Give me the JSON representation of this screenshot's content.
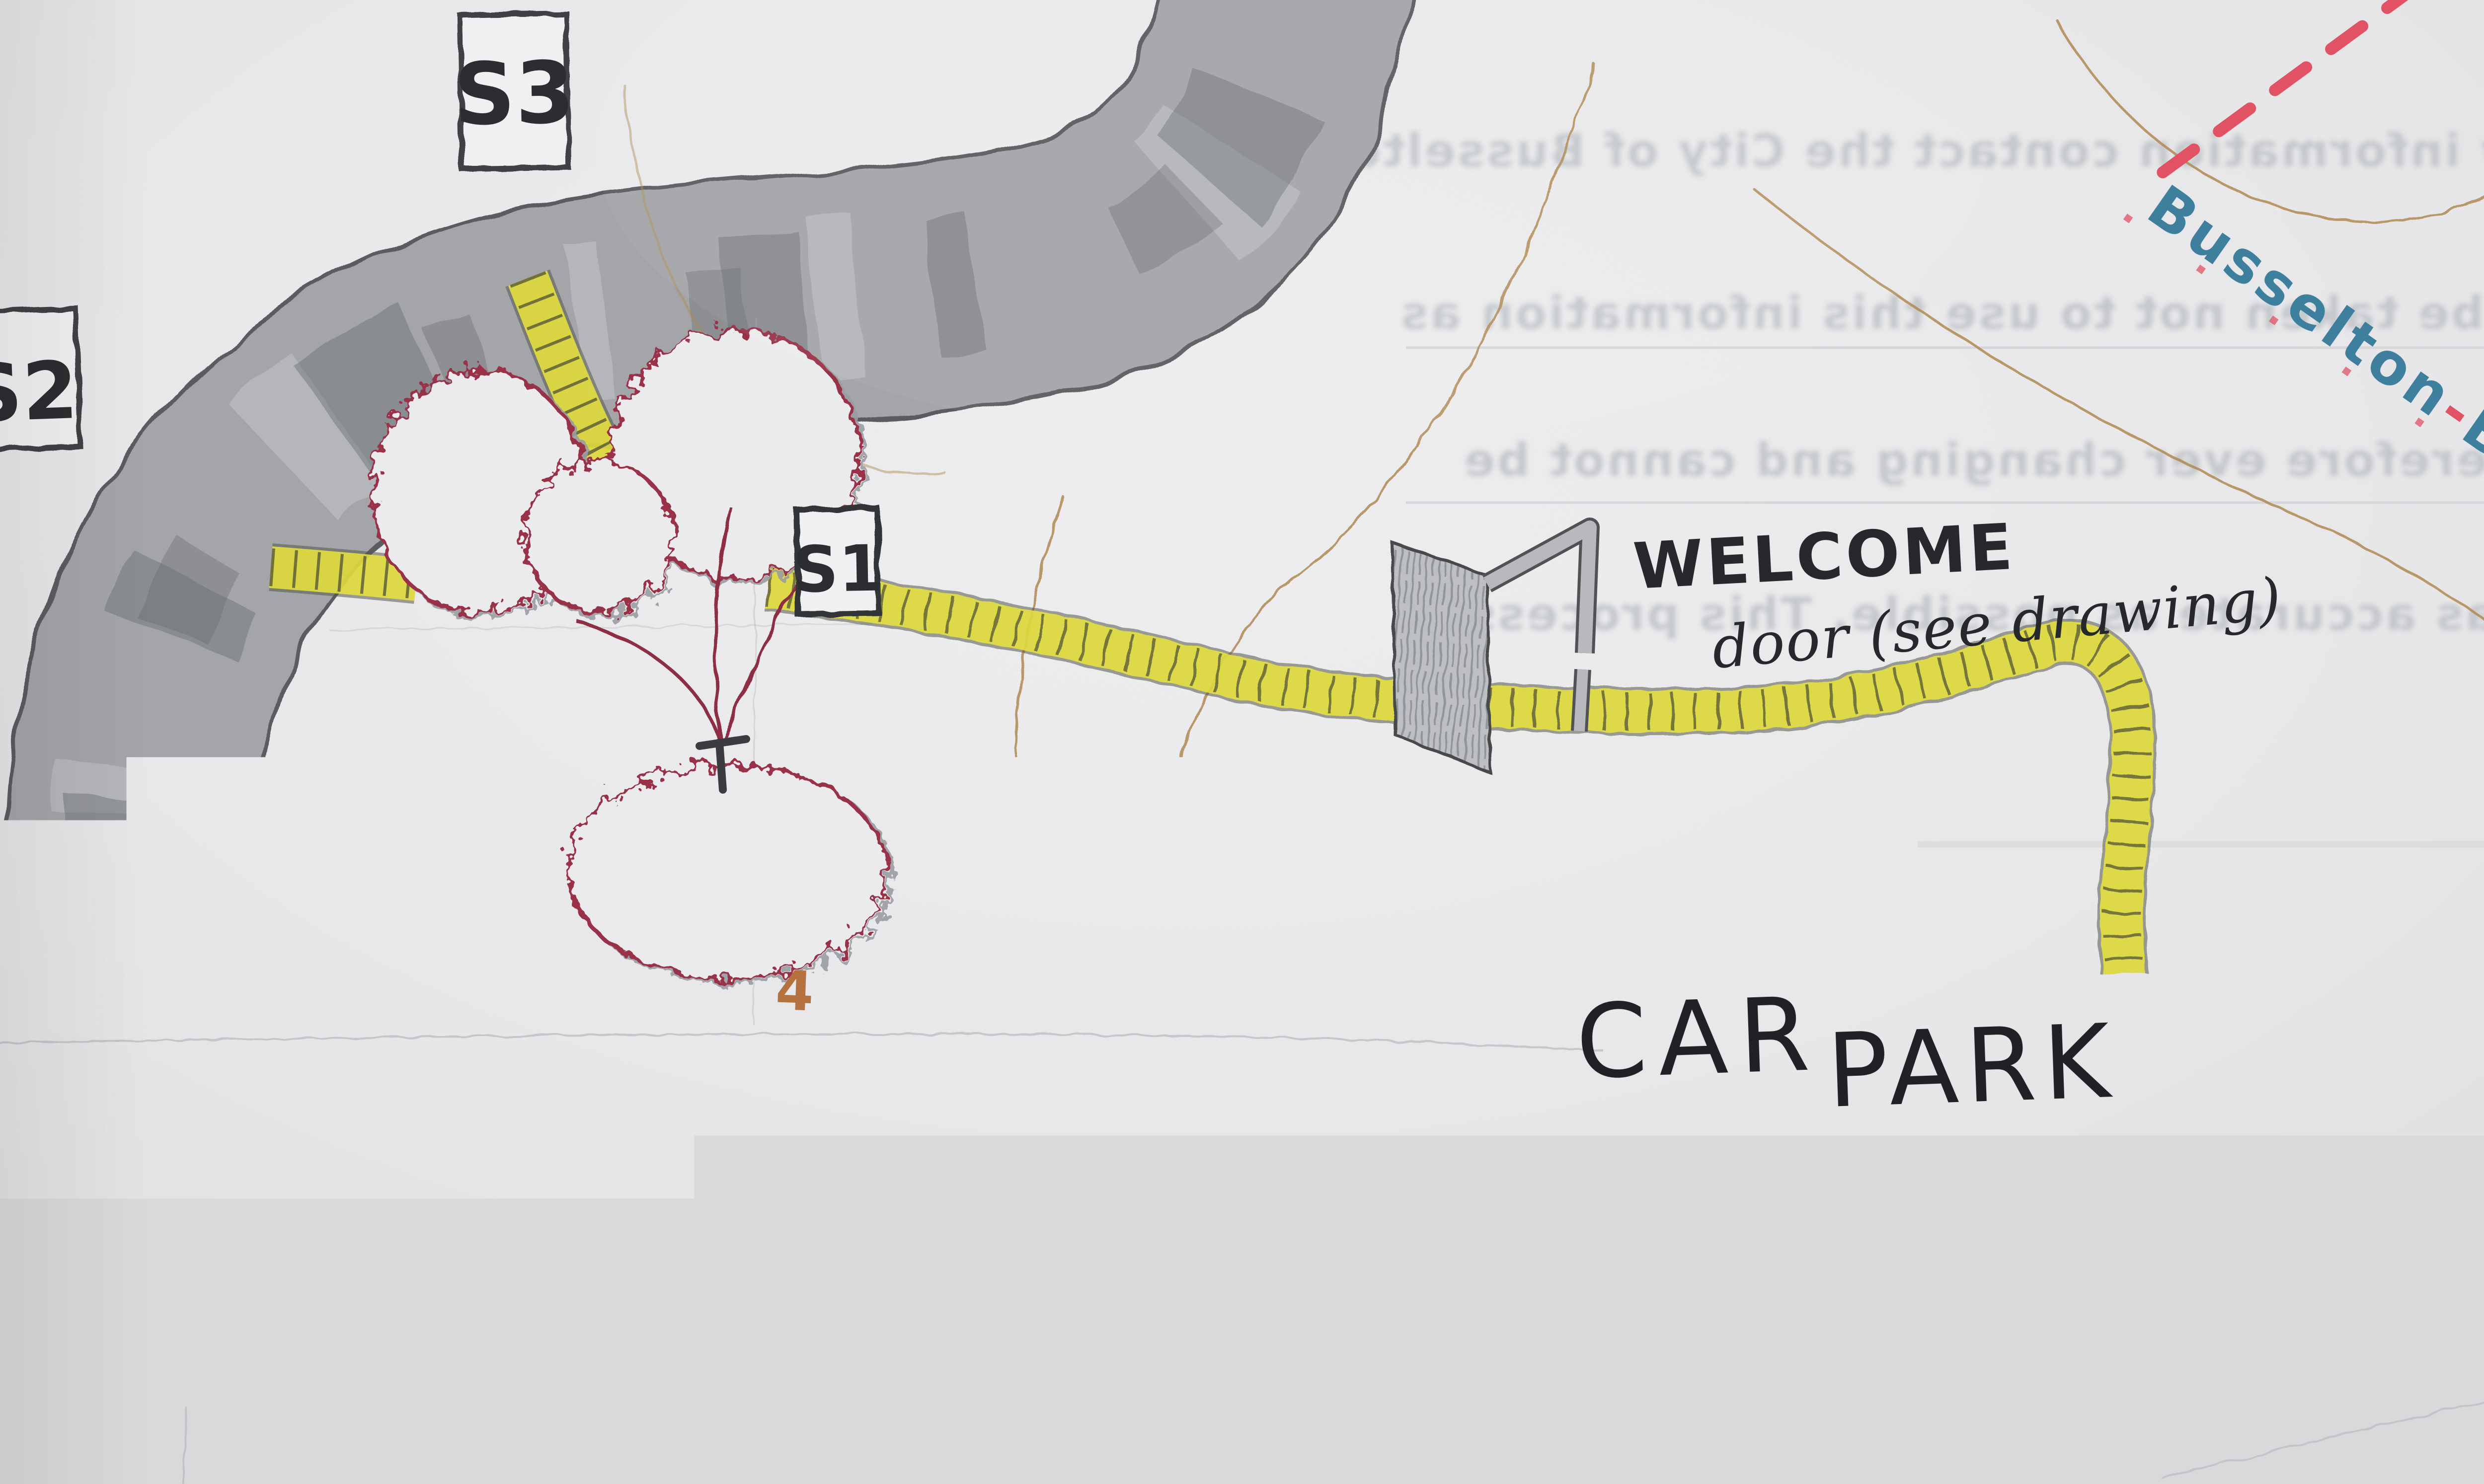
{
  "map": {
    "stations": {
      "s3": {
        "label": "S3"
      },
      "s2": {
        "label": "S2"
      },
      "s1": {
        "label": "S1"
      }
    },
    "annotations": {
      "welcome_title": "WELCOME",
      "welcome_note": "door (see drawing)",
      "car_park_word_1": "CAR",
      "car_park_word_2": "PARK",
      "plot_number": "4"
    },
    "roads": {
      "bypass_name_part_1": "Busselton",
      "bypass_name_separator": "-",
      "bypass_name_part_2": "Bypass"
    },
    "bleed_through_text": {
      "line_1": "verify information contact the City of Busselton",
      "line_2": "must be taken not to use this information as",
      "line_3": "is therefore ever changing and cannot be",
      "line_4": "here as accurate as possible. This process is"
    },
    "colors": {
      "paper": "#e9e9eb",
      "road_gray": "#a3a5a9",
      "road_edge": "#5a5c60",
      "car_park_gray": "#b6b8bc",
      "contour_tan": "#b08a52",
      "trail_yellow": "#e9e43c",
      "tree_outline_red": "#99304a",
      "bypass_text_blue": "#3f7f9e",
      "bypass_dash_red": "#e05264",
      "ink_black": "#26282b"
    }
  }
}
